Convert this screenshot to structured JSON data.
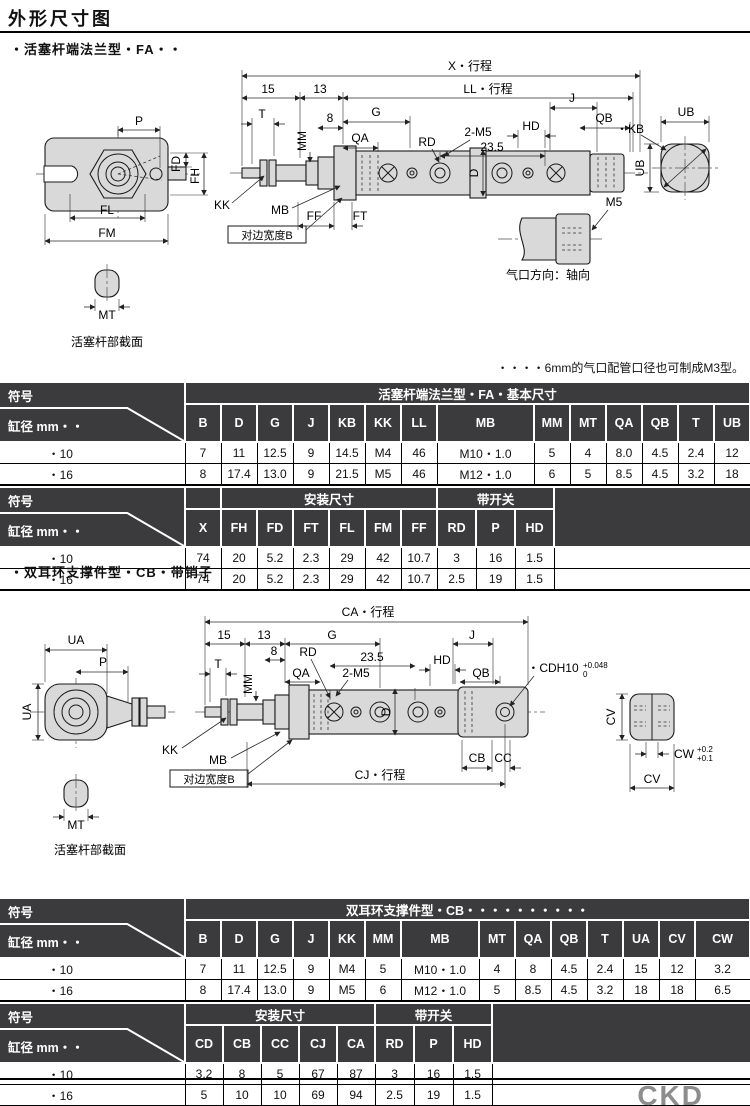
{
  "page": {
    "title": "外形尺寸图",
    "brand": "CKD"
  },
  "section1": {
    "heading": "・活塞杆端法兰型・FA・・",
    "note": "・・・・6mm的气口配管口径也可制成M3型。"
  },
  "section2": {
    "heading": "・双耳环支撑件型・CB・带销子"
  },
  "d1": {
    "x_stroke": "X・行程",
    "dim15": "15",
    "dim13": "13",
    "ll_stroke": "LL・行程",
    "t": "T",
    "dim8": "8",
    "g": "G",
    "qa": "QA",
    "rd": "RD",
    "m5x2": "2-M5",
    "dim235": "23.5",
    "mm": "MM",
    "j": "J",
    "hd": "HD",
    "qb": "QB",
    "kb": "・KB",
    "ub_top": "UB",
    "ub_side": "UB",
    "p": "P",
    "fd": "FD",
    "fh": "FH",
    "fl": "FL",
    "fm": "FM",
    "kk": "KK",
    "mb": "MB",
    "flat_b": "对边宽度B",
    "ff": "FF",
    "ft": "FT",
    "d": "D",
    "m5": "M5",
    "port_caption": "气口方向：轴向",
    "mt": "MT",
    "rod_caption": "活塞杆部截面"
  },
  "d2": {
    "ca_stroke": "CA・行程",
    "dim15": "15",
    "dim13": "13",
    "g": "G",
    "dim8": "8",
    "rd": "RD",
    "dim235": "23.5",
    "qa": "QA",
    "m5x2": "2-M5",
    "t": "T",
    "mm": "MM",
    "j": "J",
    "hd": "HD",
    "qb": "QB",
    "cdh10": "・CDH10",
    "cdh10_sup": "+0.048",
    "cdh10_sub": "0",
    "ua_top": "UA",
    "p": "P",
    "ua_side": "UA",
    "kk": "KK",
    "mb": "MB",
    "flat_b": "对边宽度B",
    "cj_stroke": "CJ・行程",
    "cb": "CB",
    "cc": "CC",
    "cw": "CW",
    "cw_sup": "+0.2",
    "cw_sub": "+0.1",
    "cv_side": "CV",
    "cv_bottom": "CV",
    "d": "D",
    "mt": "MT",
    "rod_caption": "活塞杆部截面"
  },
  "table1": {
    "corner_top": "符号",
    "corner_bottom": "缸径 mm・・",
    "partA": {
      "group": "活塞杆端法兰型・FA・基本尺寸",
      "cols": [
        "B",
        "D",
        "G",
        "J",
        "KB",
        "KK",
        "LL",
        "MB",
        "MM",
        "MT",
        "QA",
        "QB",
        "T",
        "UB"
      ],
      "rows": [
        {
          "label": "・10",
          "values": [
            "7",
            "11",
            "12.5",
            "9",
            "14.5",
            "M4",
            "46",
            "M10・1.0",
            "5",
            "4",
            "8.0",
            "4.5",
            "2.4",
            "12"
          ]
        },
        {
          "label": "・16",
          "values": [
            "8",
            "17.4",
            "13.0",
            "9",
            "21.5",
            "M5",
            "46",
            "M12・1.0",
            "6",
            "5",
            "8.5",
            "4.5",
            "3.2",
            "18"
          ]
        }
      ]
    },
    "partB": {
      "group_install": "安装尺寸",
      "group_switch": "带开关",
      "cols": [
        "X",
        "FH",
        "FD",
        "FT",
        "FL",
        "FM",
        "FF",
        "RD",
        "P",
        "HD"
      ],
      "rows": [
        {
          "label": "・10",
          "values": [
            "74",
            "20",
            "5.2",
            "2.3",
            "29",
            "42",
            "10.7",
            "3",
            "16",
            "1.5"
          ]
        },
        {
          "label": "・16",
          "values": [
            "74",
            "20",
            "5.2",
            "2.3",
            "29",
            "42",
            "10.7",
            "2.5",
            "19",
            "1.5"
          ]
        }
      ]
    }
  },
  "table2": {
    "corner_top": "符号",
    "corner_bottom": "缸径 mm・・",
    "partA": {
      "group": "双耳环支撑件型・CB・・・・・・・・・・",
      "cols": [
        "B",
        "D",
        "G",
        "J",
        "KK",
        "MM",
        "MB",
        "MT",
        "QA",
        "QB",
        "T",
        "UA",
        "CV",
        "CW"
      ],
      "rows": [
        {
          "label": "・10",
          "values": [
            "7",
            "11",
            "12.5",
            "9",
            "M4",
            "5",
            "M10・1.0",
            "4",
            "8",
            "4.5",
            "2.4",
            "15",
            "12",
            "3.2"
          ]
        },
        {
          "label": "・16",
          "values": [
            "8",
            "17.4",
            "13.0",
            "9",
            "M5",
            "6",
            "M12・1.0",
            "5",
            "8.5",
            "4.5",
            "3.2",
            "18",
            "18",
            "6.5"
          ]
        }
      ]
    },
    "partB": {
      "group_install": "安装尺寸",
      "group_switch": "带开关",
      "cols": [
        "CD",
        "CB",
        "CC",
        "CJ",
        "CA",
        "RD",
        "P",
        "HD"
      ],
      "rows": [
        {
          "label": "・10",
          "values": [
            "3.2",
            "8",
            "5",
            "67",
            "87",
            "3",
            "16",
            "1.5"
          ]
        },
        {
          "label": "・16",
          "values": [
            "5",
            "10",
            "10",
            "69",
            "94",
            "2.5",
            "19",
            "1.5"
          ]
        }
      ]
    }
  }
}
